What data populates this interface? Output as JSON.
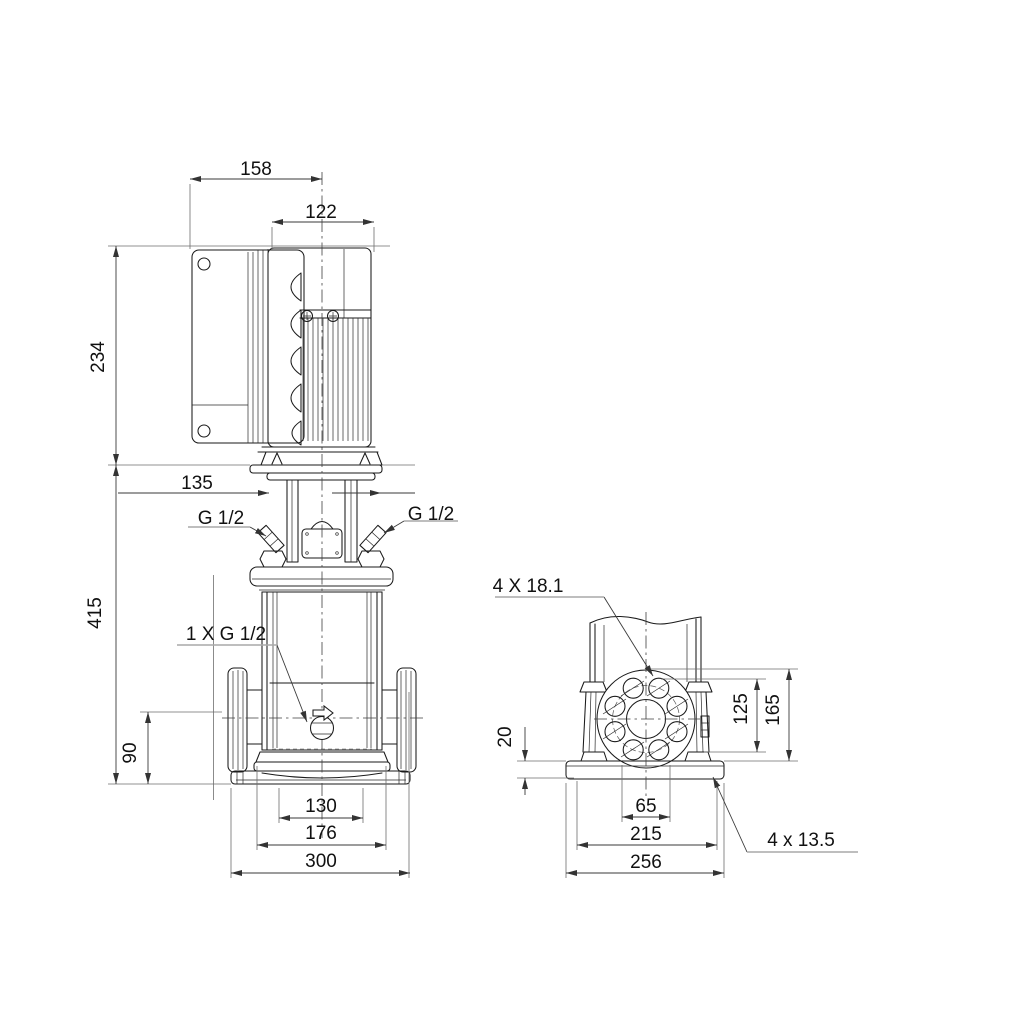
{
  "drawing": {
    "kind": "technical dimensional drawing, vertical multistage pump, front and side views",
    "units": "mm",
    "colors": {
      "background": "#ffffff",
      "line": "#1a1a1a",
      "dimension": "#3a3a3a",
      "extension": "#6e6e6e"
    },
    "front": {
      "dims": {
        "top_width": "158",
        "motor_width": "122",
        "motor_height": "234",
        "head_width": "135",
        "pump_height": "415",
        "port_height": "90",
        "base_step_width": "130",
        "column_width": "176",
        "base_width": "300"
      },
      "labels": {
        "left_plug": "G 1/2",
        "right_plug": "G 1/2",
        "drain_plug": "1 X G 1/2"
      }
    },
    "side": {
      "dims": {
        "plate_thickness": "20",
        "hole_height_inner": "125",
        "hole_height_outer": "165",
        "bore_width": "65",
        "bolt_spacing": "215",
        "base_depth": "256"
      },
      "labels": {
        "flange_holes": "4 X 18.1",
        "base_holes": "4 x 13.5"
      }
    }
  }
}
